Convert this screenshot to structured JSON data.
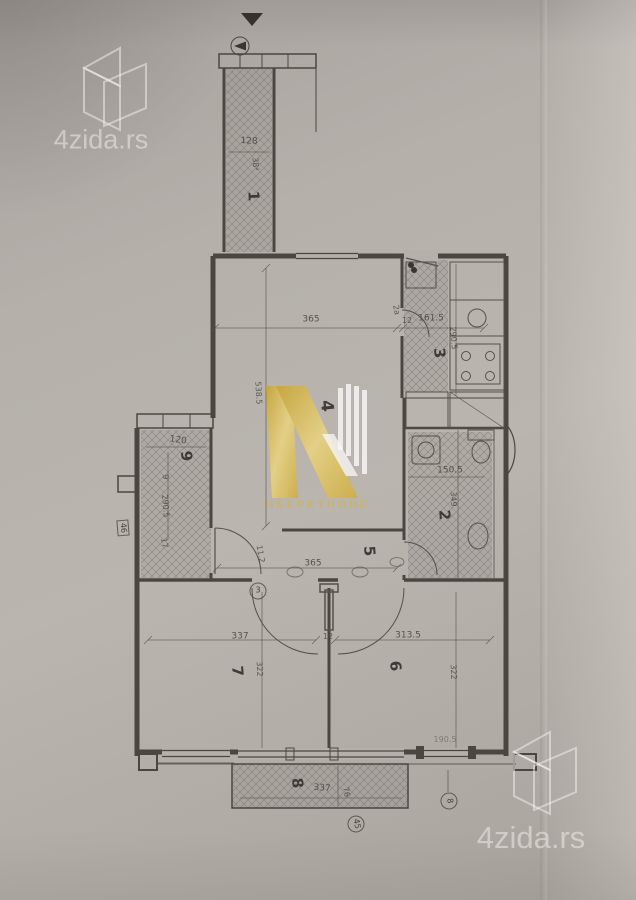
{
  "watermarks": {
    "top_left_brand": "4zida.rs",
    "bottom_right_brand": "4zida.rs",
    "center_text": "НЕКРЕТНИНЕ"
  },
  "plan": {
    "room_numbers": {
      "r1": "1",
      "r2": "2",
      "r3": "3",
      "r4": "4",
      "r5": "5",
      "r6": "6",
      "r7": "7",
      "r8": "8",
      "r9": "9"
    },
    "dims": {
      "r1_width": "128",
      "r1_area": "38²",
      "r3_door": "2a",
      "r3_wall": "12",
      "r3_width": "161.5",
      "r3_height": "290.5",
      "r4_width": "365",
      "r4_height": "538.5",
      "r2_width": "150.5",
      "r2_height": "349",
      "r9_width": "120",
      "r9_side": "9",
      "r9_height": "290.5",
      "r9_note": "17",
      "hall_width": "365",
      "hall_note": "11.2",
      "r7_width": "337",
      "r7_height": "322",
      "r67_wall": "12",
      "r6_width": "313.5",
      "r6_height": "322",
      "r8_width": "337",
      "r8_depth": "76",
      "bottom_right_dim": "190.5"
    },
    "markers": {
      "left_boxed": "46",
      "hall_door_circle": "3",
      "terrace_circle": "45",
      "bottom_right_circle": "8"
    }
  },
  "colors": {
    "paper": "#b4afa9",
    "ink": "#4b4640",
    "hatch": "#6e675f",
    "gold": "#d2b14e",
    "watermark": "#e8e5e1"
  }
}
